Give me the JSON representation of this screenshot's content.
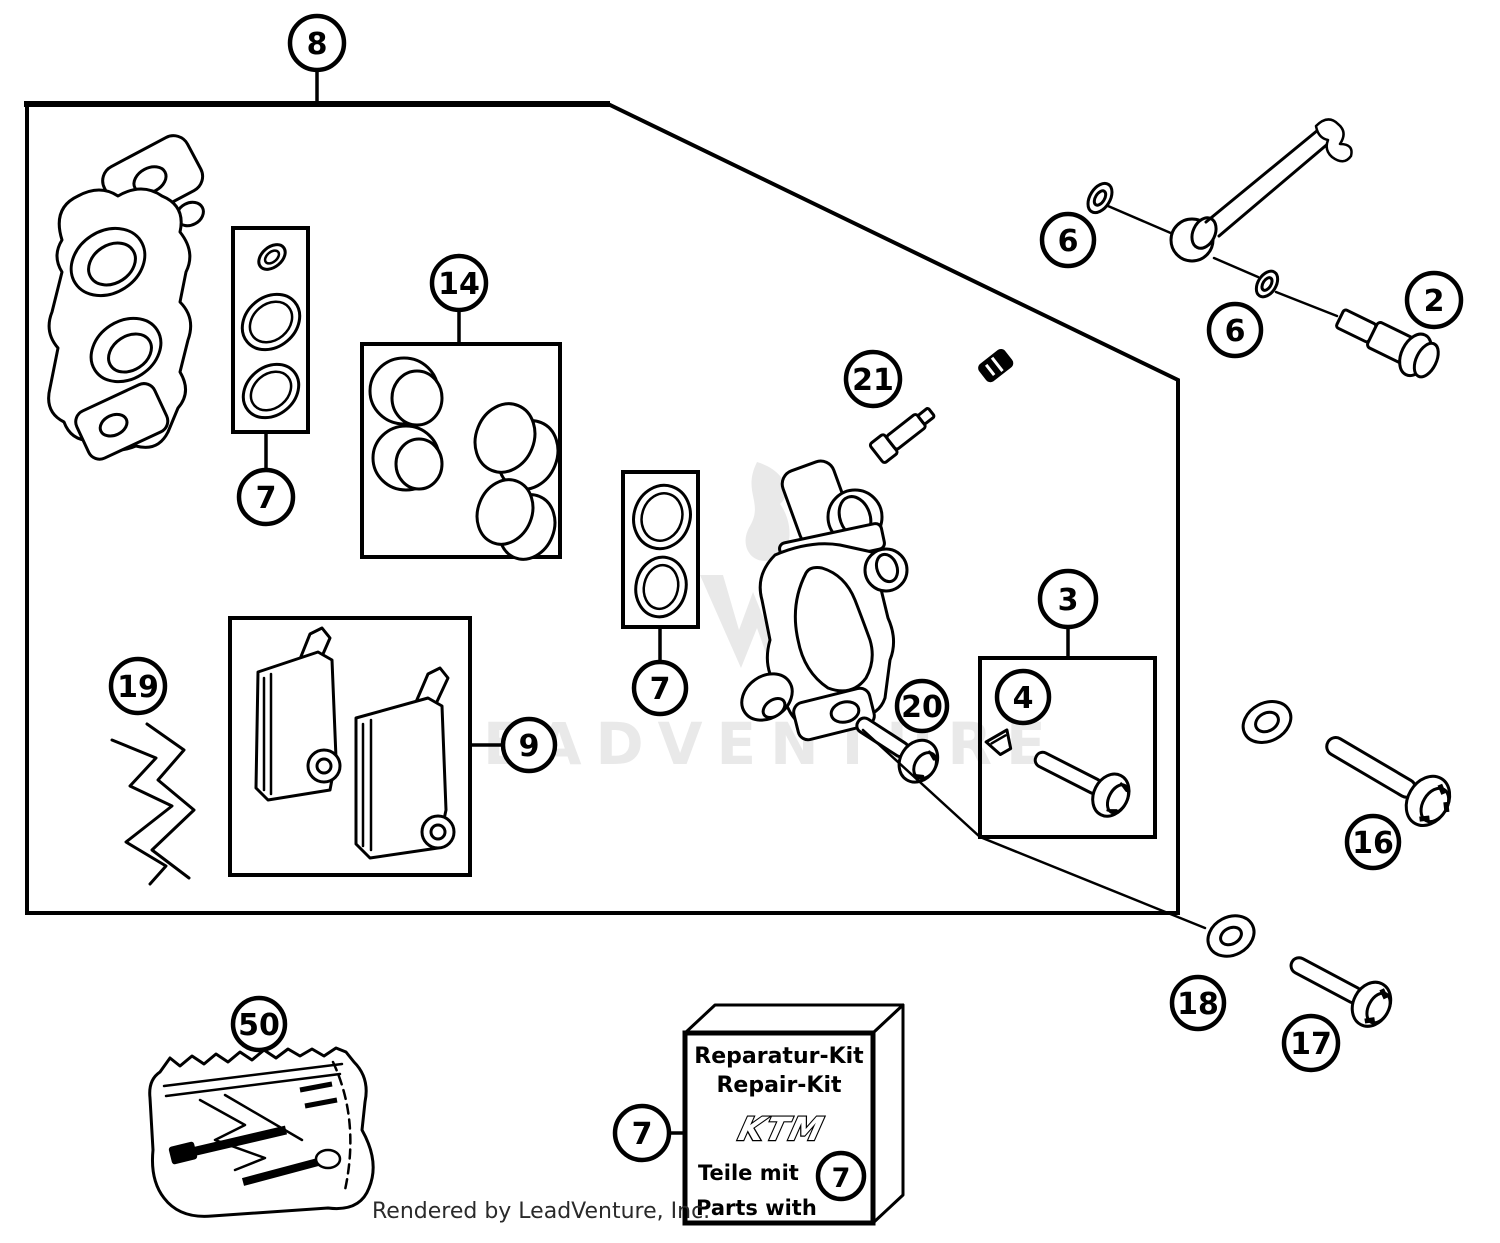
{
  "page": {
    "credit": "Rendered by LeadVenture, Inc.",
    "watermark_text": "EADVENTURE",
    "background": "#ffffff",
    "line_color": "#000000",
    "watermark_color": "#e9e9e9"
  },
  "callouts": {
    "c8": "8",
    "c14": "14",
    "c7a": "7",
    "c7b": "7",
    "c9": "9",
    "c19": "19",
    "c3": "3",
    "c4": "4",
    "c20": "20",
    "c21": "21",
    "c6a": "6",
    "c6b": "6",
    "c2": "2",
    "c16": "16",
    "c18": "18",
    "c17": "17",
    "c50": "50",
    "c7c": "7",
    "c7kit": "7"
  },
  "kit_box": {
    "title_de": "Reparatur-Kit",
    "title_en": "Repair-Kit",
    "brand": "KTM",
    "note_de": "Teile mit",
    "note_en": "Parts with"
  }
}
